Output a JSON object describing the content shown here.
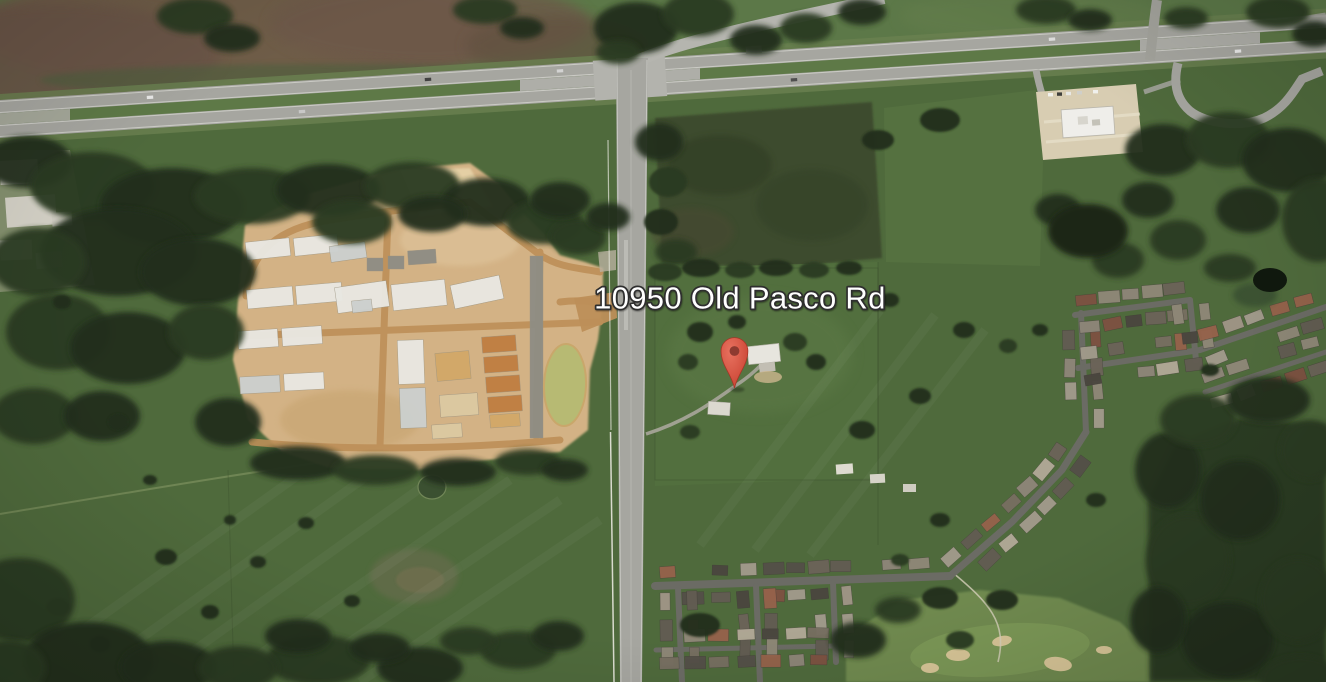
{
  "map": {
    "type": "satellite-imagery",
    "address_label": "10950 Old Pasco Rd",
    "marker": {
      "icon": "location-pin",
      "x_pct": 55.39,
      "y_pct": 56.89,
      "color": "#DC5145",
      "inner_color": "#8E3A30"
    },
    "label": {
      "x_pct": 55.8,
      "y_pct": 45.2,
      "text_color": "#FFFFFF",
      "halo_color": "#2D2D2D"
    },
    "visible_features": [
      "divided-highway",
      "old-pasco-road",
      "road-intersection",
      "construction-site",
      "new-home-slabs",
      "lumber-stacks",
      "retention-pond",
      "pastures",
      "forest",
      "rural-homestead",
      "farm-sheds",
      "residential-subdivision",
      "golf-course",
      "commercial-building",
      "parking-lot",
      "interchange-loop-ramp",
      "industrial-buildings",
      "wetland-patch"
    ]
  },
  "palette": {
    "pasture": "#4f6a3c",
    "pasture2": "#557140",
    "northgreen": "#5c7848",
    "brownfield": "#715c49",
    "forest": "#2b3a24",
    "forestdark": "#212e1a",
    "forestlight": "#3a5130",
    "darkfield": "#3d4b2e",
    "sand": "#d3b285",
    "sandlight": "#e4cfa4",
    "sanddark": "#bd8f58",
    "slab": "#e9e8e2",
    "silver": "#ccd0ce",
    "pad": "#8f8d84",
    "tan": "#d2a868",
    "lumber": "#c07f42",
    "beige": "#dcc9a2",
    "pond": "#b7ba73",
    "ponddark": "#3a4f31",
    "asphalt": "#a6a6a0",
    "asphaltlight": "#b5b5af",
    "street": "#6b6b64",
    "lot": "#d8cdb2",
    "bldg": "#efeeea",
    "golf": "#6f8a4f",
    "golflight": "#7e9a58",
    "bunker": "#d7c597",
    "marker": "#DC5145",
    "markerdark": "#8E3A30",
    "label": "#FFFFFF",
    "halo": "#2D2D2D",
    "whiteline": "#e8e8de"
  }
}
